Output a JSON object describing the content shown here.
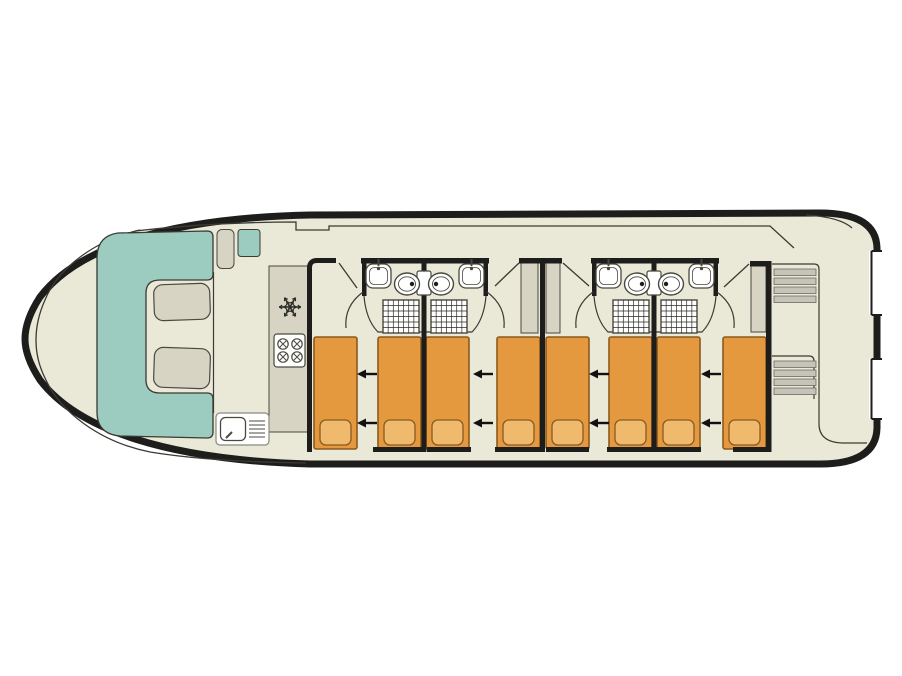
{
  "diagram": {
    "type": "boat-floor-plan",
    "view": "top-down deck plan of a canal houseboat",
    "areas": {
      "bow_salon": {
        "sofa": "U-shaped bench",
        "table_cushions": 2,
        "helm_seat": 1,
        "side_bench": 1
      },
      "galley": {
        "fridge": "snowflake-icon",
        "stove_burners": 4,
        "sink": 1,
        "drainer": 1
      },
      "cabins": 4,
      "beds": 8,
      "convertible_bed_arrows": 8,
      "bathrooms": 4,
      "bathroom_fixtures": [
        "sink",
        "toilet",
        "shower"
      ],
      "wardrobes": 3,
      "stern": {
        "stair_flights": 2,
        "steps_per_flight": 4,
        "aft_deck": true,
        "boarding_gates": 2
      }
    }
  },
  "colors": {
    "background": "#ffffff",
    "hull_outline": "#1d1d1b",
    "deck": "#eae8d7",
    "sofa_teal": "#9ccbbf",
    "furniture": "#d7d4c3",
    "bed": "#e5993f",
    "pillow": "#f0ba6e",
    "bed_outline": "#8a5a1e",
    "wall": "#1d1d1b",
    "thin_line": "#3b3a33",
    "fixture_outline": "#4a4940",
    "step": "#c6c4b8",
    "white": "#ffffff",
    "drainer_line": "#6b6a60",
    "arrow": "#111111"
  },
  "layout": {
    "bed_geom": {
      "y": 337,
      "w": 43,
      "h": 112
    },
    "pillow_geom": {
      "dy": 83,
      "w": 31,
      "h": 25
    },
    "beds": [
      {
        "x": 314
      },
      {
        "x": 378
      },
      {
        "x": 426
      },
      {
        "x": 497
      },
      {
        "x": 546
      },
      {
        "x": 609
      },
      {
        "x": 657
      },
      {
        "x": 723
      }
    ],
    "arrows": {
      "xs": [
        367,
        483,
        599,
        711
      ],
      "ys": [
        374,
        423
      ]
    },
    "foot_bars": [
      {
        "x": 373,
        "w": 52
      },
      {
        "x": 427,
        "w": 44
      },
      {
        "x": 495,
        "w": 46
      },
      {
        "x": 546,
        "w": 43
      },
      {
        "x": 607,
        "w": 45
      },
      {
        "x": 656,
        "w": 45
      },
      {
        "x": 733,
        "w": 34
      }
    ],
    "stairs": [
      {
        "x": 774,
        "y": 269
      },
      {
        "x": 774,
        "y": 361
      }
    ],
    "step_geom": {
      "w": 42,
      "h": 6.5,
      "pitch": 9,
      "count": 4
    },
    "burners": [
      [
        283,
        344
      ],
      [
        297,
        344
      ],
      [
        283,
        357
      ],
      [
        297,
        357
      ]
    ],
    "burner_r": 5.2,
    "snowflake": {
      "cx": 290,
      "cy": 307,
      "r": 11
    },
    "drainer": {
      "x1": 249,
      "x2": 265,
      "y0": 421,
      "dy": 4,
      "n": 5
    },
    "shower_grid": {
      "cols": 7,
      "rows": 6
    }
  }
}
